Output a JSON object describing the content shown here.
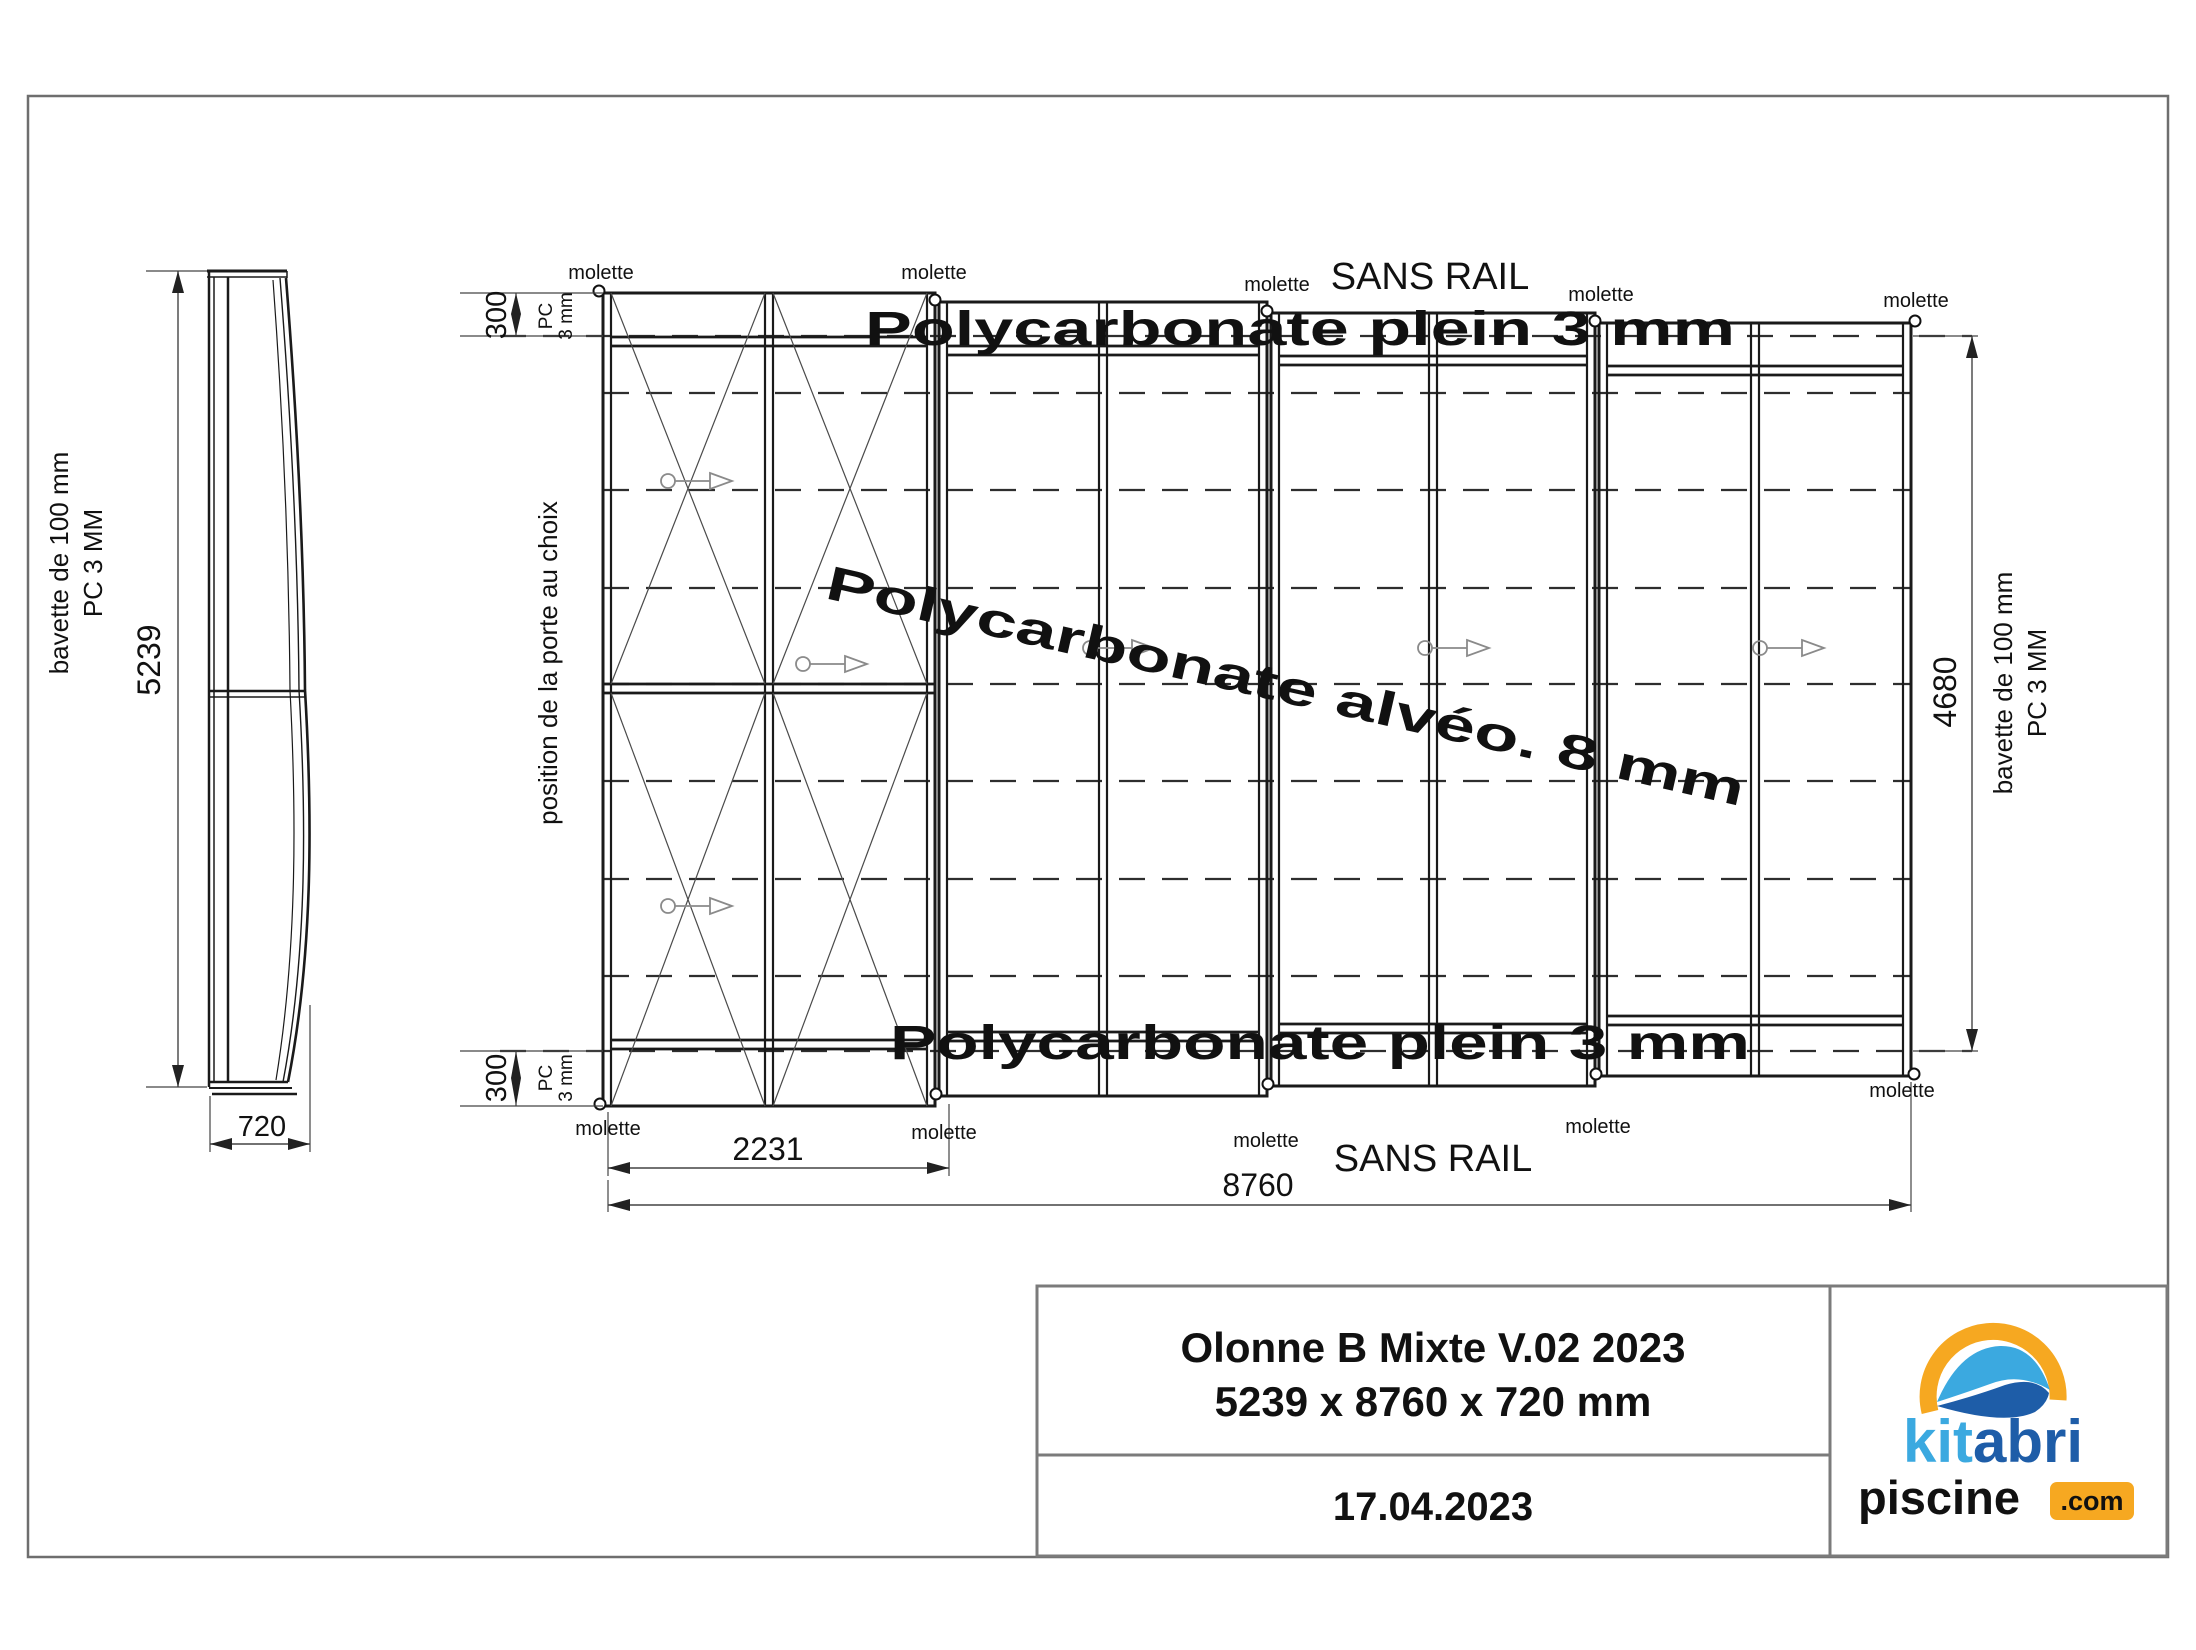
{
  "side_view": {
    "dim_width": "5239",
    "dim_depth": "720"
  },
  "plan_view": {
    "rail_note": "SANS RAIL",
    "glazing_edge": "Polycarbonate plein 3 mm",
    "glazing_roof": "Polycarbonate alvéo. 8 mm",
    "molette": "molette",
    "door_note": "position de la porte au choix",
    "dim_overhang": "300",
    "pc_note_line1": "PC",
    "pc_note_line2": "3 mm",
    "dim_first_module": "2231",
    "dim_length": "8760",
    "dim_inner_width": "4680",
    "bavette_note_line1": "bavette de 100 mm",
    "bavette_note_line2": "PC 3 MM"
  },
  "title_block": {
    "title": "Olonne B Mixte V.02 2023",
    "dimensions": "5239 x 8760 x 720 mm",
    "date": "17.04.2023"
  },
  "logo": {
    "word1": "kit",
    "word2": "abri",
    "word3": "piscine",
    "word4": ".com"
  },
  "colors": {
    "logo_light_blue": "#3BA9E0",
    "logo_dark_blue": "#1E5DA8",
    "logo_orange": "#F6A821"
  }
}
